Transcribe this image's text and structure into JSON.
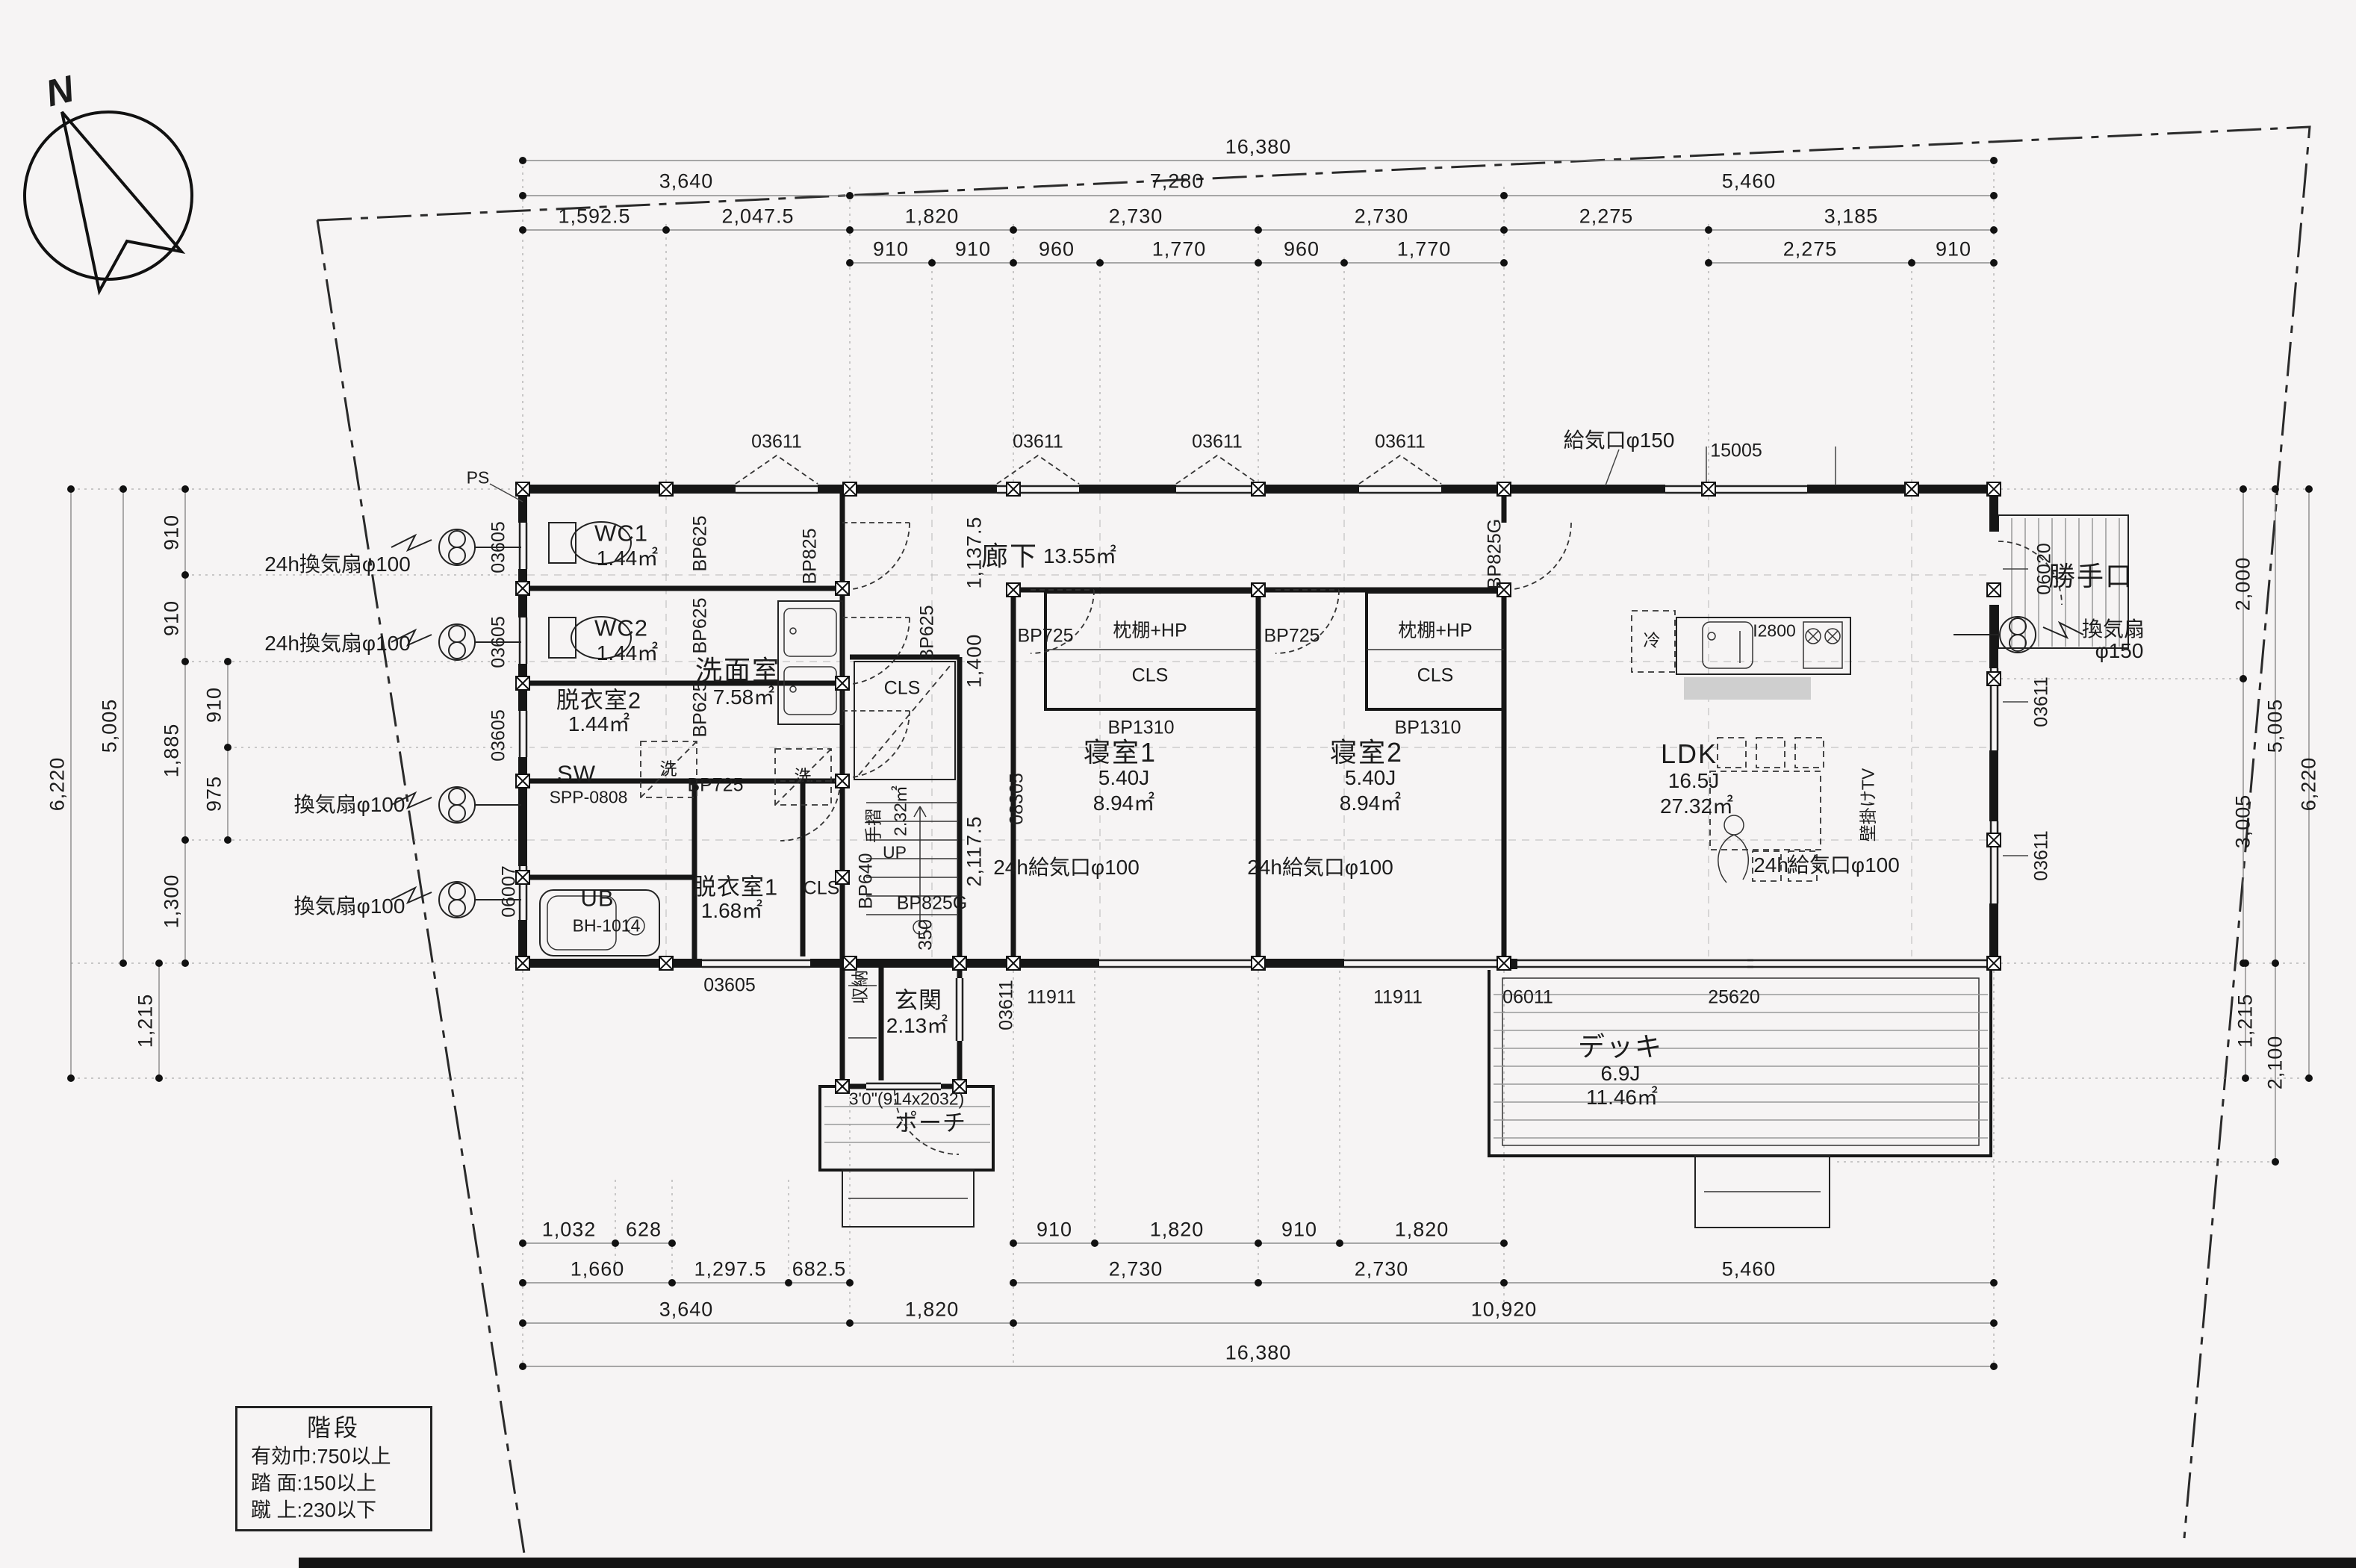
{
  "compass": {
    "n": "N"
  },
  "legend": {
    "title": "階段",
    "rows": [
      "有効巾:750以上",
      "踏 面:150以上",
      "蹴 上:230以下"
    ]
  },
  "rooms": {
    "wc1": {
      "name": "WC1",
      "area": "1.44㎡"
    },
    "wc2": {
      "name": "WC2",
      "area": "1.44㎡"
    },
    "dressing2": {
      "name": "脱衣室2",
      "area": "1.44㎡"
    },
    "washroom": {
      "name": "洗面室",
      "area": "7.58㎡"
    },
    "sw": {
      "name": "SW",
      "model": "SPP-0808"
    },
    "ub": {
      "name": "UB",
      "model": "BH-1014"
    },
    "dressing1": {
      "name": "脱衣室1",
      "area": "1.68㎡"
    },
    "stairs": {
      "handrail": "手摺",
      "area": "2.32㎡",
      "up": "UP",
      "closet": "CLS"
    },
    "entrance": {
      "name": "玄関",
      "area": "2.13㎡",
      "storage": "収納",
      "door": "3'0\"(914x2032)"
    },
    "porch": {
      "name": "ポーチ"
    },
    "hallway": {
      "name": "廊下",
      "area": "13.55㎡"
    },
    "bedroom1": {
      "name": "寝室1",
      "size": "5.40J",
      "area": "8.94㎡",
      "shelf": "枕棚+HP",
      "closet": "CLS"
    },
    "bedroom2": {
      "name": "寝室2",
      "size": "5.40J",
      "area": "8.94㎡",
      "shelf": "枕棚+HP",
      "closet": "CLS"
    },
    "ldk": {
      "name": "LDK",
      "size": "16.5J",
      "area": "27.32㎡",
      "tv": "壁掛けTV",
      "fridge": "冷",
      "kitchen": "I2800"
    },
    "deck": {
      "name": "デッキ",
      "size": "6.9J",
      "area": "11.46㎡"
    },
    "backdoor": {
      "name": "勝手口"
    },
    "closet": "CLS",
    "washer": "洗",
    "ps": "PS"
  },
  "equipment": {
    "fan24_100": "24h換気扇φ100",
    "fan_100": "換気扇φ100",
    "fan150a": "換気扇",
    "fan150b": "φ150",
    "supply24_100": "24h給気口φ100",
    "supply_150": "給気口φ150"
  },
  "codes": {
    "w03605": "03605",
    "w03611": "03611",
    "w06007": "06007",
    "w06020": "06020",
    "w15005": "15005",
    "w11911": "11911",
    "w06011": "06011",
    "w25620": "25620",
    "w08305": "08305",
    "d350": "350",
    "bp625": "BP625",
    "bp825": "BP825",
    "bp725": "BP725",
    "bp640": "BP640",
    "bp1310": "BP1310",
    "bp825g": "BP825G"
  },
  "dims": {
    "top1": [
      "16,380"
    ],
    "top2": [
      "3,640",
      "7,280",
      "5,460"
    ],
    "top3": [
      "1,592.5",
      "2,047.5",
      "1,820",
      "2,730",
      "2,730",
      "2,275",
      "3,185"
    ],
    "top4": [
      "910",
      "910",
      "960",
      "1,770",
      "960",
      "1,770",
      "2,275",
      "910"
    ],
    "bottom1": [
      "1,032",
      "628",
      "910",
      "1,820",
      "910",
      "1,820"
    ],
    "bottom2": [
      "1,660",
      "1,297.5",
      "682.5",
      "2,730",
      "2,730",
      "5,460"
    ],
    "bottom3": [
      "3,640",
      "1,820",
      "10,920"
    ],
    "bottom4": [
      "16,380"
    ],
    "left": [
      "910",
      "910",
      "910",
      "975",
      "1,885",
      "1,300",
      "5,005",
      "1,215",
      "6,220"
    ],
    "right": [
      "2,000",
      "5,005",
      "3,005",
      "6,220",
      "1,215",
      "2,100"
    ],
    "inner": [
      "1,137.5",
      "1,400",
      "2,117.5"
    ]
  }
}
